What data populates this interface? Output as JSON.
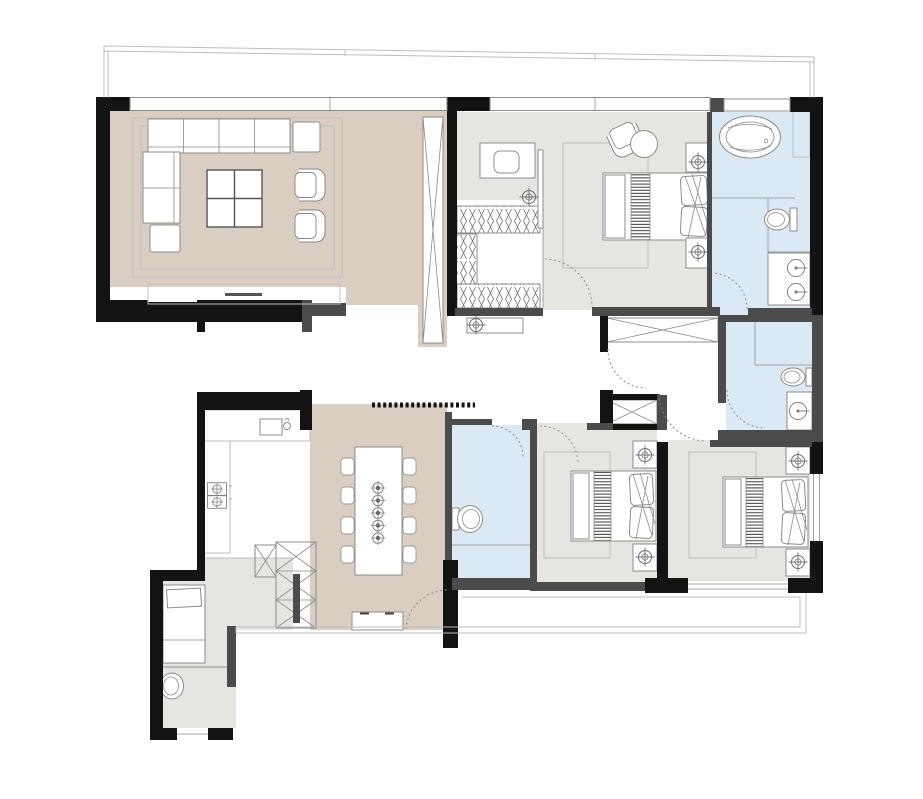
{
  "canvas": {
    "width": 923,
    "height": 799,
    "background": "#ffffff"
  },
  "colors": {
    "wall": "#131313",
    "wall2": "#4b4b4b",
    "beige": "#d9cec1",
    "gray": "#e6e5e2",
    "blue": "#dbe9f5",
    "stroke": "#8c8c8c",
    "lite": "#bdbdbd",
    "door": "#8a8a8a",
    "outline": "#c4c4c4"
  },
  "plan": {
    "type": "apartment-floor-plan",
    "rooms": [
      {
        "id": "living-room",
        "floor": "beige",
        "furniture": [
          "corner-sofa",
          "coffee-table",
          "armchair",
          "armchair",
          "side-table",
          "ottoman",
          "rug",
          "tall-screen"
        ]
      },
      {
        "id": "dining-room",
        "floor": "beige",
        "furniture": [
          "dining-table",
          "dining-chairs-8",
          "place-settings-5",
          "sideboard",
          "storage-cabinets"
        ]
      },
      {
        "id": "kitchen",
        "floor": "white",
        "furniture": [
          "counter",
          "sink",
          "cooktop-2-burners"
        ]
      },
      {
        "id": "entry",
        "floor": "white",
        "furniture": []
      },
      {
        "id": "foyer",
        "floor": "white",
        "furniture": []
      },
      {
        "id": "hallway",
        "floor": "white",
        "furniture": [
          "console-table",
          "lamp",
          "wardrobe-x",
          "wardrobe-x"
        ]
      },
      {
        "id": "walk-in-closet",
        "floor": "white",
        "furniture": [
          "hanging-wardrobes",
          "ceiling-lamp"
        ]
      },
      {
        "id": "master-bedroom",
        "floor": "gray",
        "furniture": [
          "double-bed",
          "nightstand",
          "nightstand",
          "lamp",
          "lamp",
          "desk",
          "desk-chair",
          "lounge-chair",
          "round-table",
          "rug",
          "tv-panel"
        ]
      },
      {
        "id": "master-bathroom",
        "floor": "blue",
        "furniture": [
          "bathtub",
          "toilet",
          "double-sink-vanity",
          "niche-cabinet"
        ]
      },
      {
        "id": "bedroom-2",
        "floor": "gray",
        "furniture": [
          "double-bed",
          "nightstand",
          "nightstand",
          "lamp",
          "lamp",
          "rug"
        ]
      },
      {
        "id": "bedroom-3",
        "floor": "gray",
        "furniture": [
          "double-bed",
          "nightstand",
          "nightstand",
          "lamp",
          "lamp",
          "rug"
        ]
      },
      {
        "id": "bathroom-2",
        "floor": "blue",
        "furniture": [
          "toilet",
          "sink-vanity"
        ]
      },
      {
        "id": "bathroom-3",
        "floor": "blue",
        "furniture": [
          "toilet"
        ]
      },
      {
        "id": "service-room",
        "floor": "gray",
        "furniture": [
          "single-bed"
        ]
      },
      {
        "id": "service-wc",
        "floor": "gray",
        "furniture": [
          "toilet"
        ]
      },
      {
        "id": "terrace",
        "floor": "white",
        "furniture": []
      },
      {
        "id": "balcony",
        "floor": "white",
        "furniture": []
      }
    ],
    "symbols": [
      "wall-black",
      "wall-gray",
      "window-band",
      "door-swing-dashed",
      "threshold-dotted",
      "lamp-crosshair",
      "clothes-hanging-hatch",
      "cabinet-x-cross"
    ]
  }
}
